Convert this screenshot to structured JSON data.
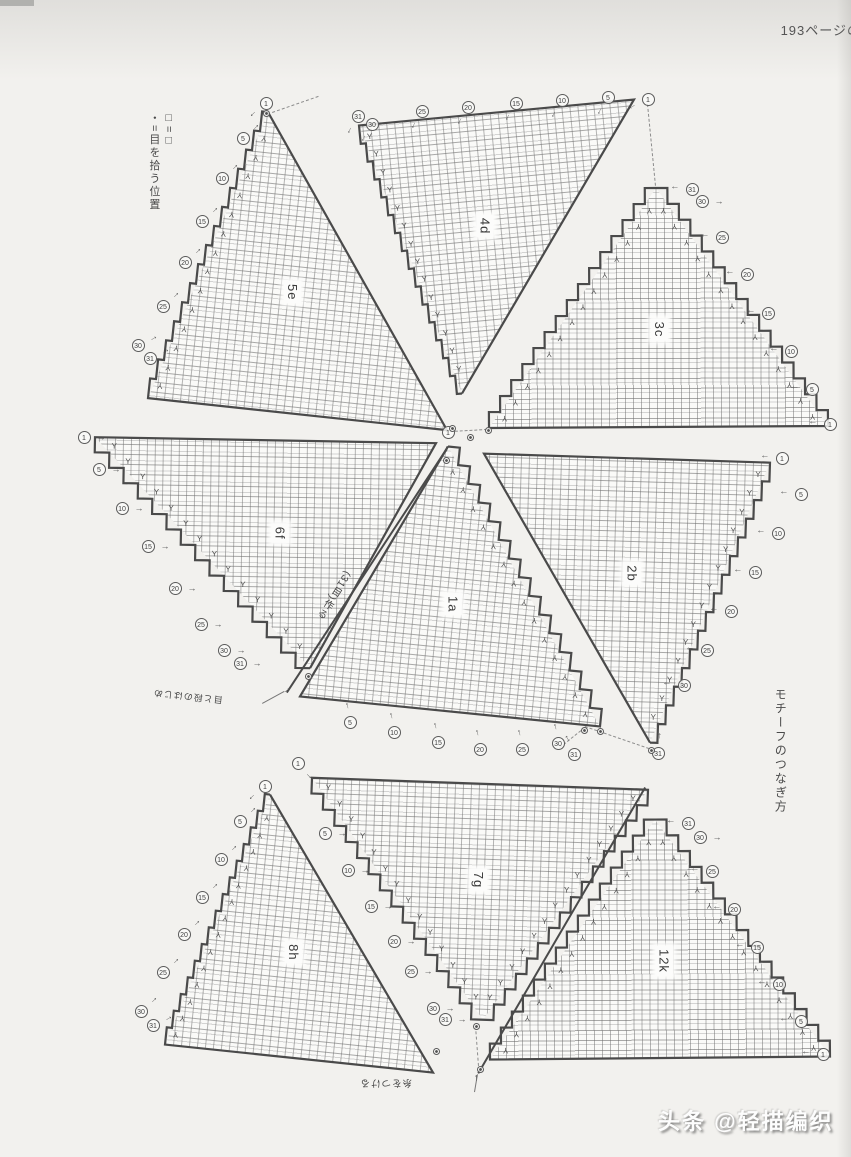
{
  "page": {
    "header_note": "193ページの続き",
    "side_note": "モチーフのつなぎ方",
    "watermark": "头条 @轻描编织",
    "legend_line1": "□=□",
    "legend_line2": "・=目を拾う位置",
    "accent_outline_color": "#4a4a4a",
    "paper_color": "#f2f1ee"
  },
  "annotations": [
    {
      "id": "cast-on-note",
      "text": "(31目)作る",
      "x": 342,
      "y": 568,
      "rotate": 33,
      "vertical": true,
      "size": 10
    },
    {
      "id": "start-note",
      "text": "目と段のはじめ",
      "x": 222,
      "y": 706,
      "rotate": 186,
      "vertical": false,
      "size": 9
    },
    {
      "id": "attach-yarn-note",
      "text": "糸をつける",
      "x": 412,
      "y": 1088,
      "rotate": 180,
      "vertical": false,
      "size": 9.5
    }
  ],
  "triangles": [
    {
      "id": "5e",
      "label": "5e",
      "apex": [
        268,
        112
      ],
      "bl": [
        148,
        398
      ],
      "br": [
        447,
        430
      ],
      "left": "step",
      "right": "line"
    },
    {
      "id": "4d",
      "label": "4d",
      "apex": [
        462,
        393
      ],
      "bl": [
        634,
        99
      ],
      "br": [
        359,
        125
      ],
      "left": "line",
      "right": "step"
    },
    {
      "id": "3c",
      "label": "3c",
      "apex": [
        656,
        188
      ],
      "bl": [
        489,
        428
      ],
      "br": [
        828,
        426
      ],
      "left": "step",
      "right": "step"
    },
    {
      "id": "6f",
      "label": "6f",
      "apex": [
        310,
        668
      ],
      "bl": [
        436,
        443
      ],
      "br": [
        95,
        437
      ],
      "left": "line",
      "right": "step"
    },
    {
      "id": "2b",
      "label": "2b",
      "apex": [
        650,
        743
      ],
      "bl": [
        770,
        463
      ],
      "br": [
        484,
        454
      ],
      "left": "step",
      "right": "line"
    },
    {
      "id": "1a",
      "label": "1a",
      "apex": [
        448,
        446
      ],
      "bl": [
        300,
        696
      ],
      "br": [
        600,
        726
      ],
      "left": "line",
      "right": "step"
    },
    {
      "id": "7g",
      "label": "7g",
      "apex": [
        483,
        1020
      ],
      "bl": [
        648,
        790
      ],
      "br": [
        312,
        778
      ],
      "left": "step",
      "right": "step"
    },
    {
      "id": "8h",
      "label": "8h",
      "apex": [
        270,
        795
      ],
      "bl": [
        165,
        1045
      ],
      "br": [
        433,
        1073
      ],
      "left": "step",
      "right": "line"
    },
    {
      "id": "12k",
      "label": "12k",
      "apex": [
        655,
        820
      ],
      "bl": [
        490,
        1060
      ],
      "br": [
        830,
        1057
      ],
      "left": "step",
      "right": "step"
    }
  ],
  "markers": [
    {
      "x": 266,
      "y": 103,
      "n": "1",
      "ad": 135
    },
    {
      "x": 243,
      "y": 138,
      "n": "5",
      "ad": -45
    },
    {
      "x": 222,
      "y": 178,
      "n": "10",
      "ad": -45
    },
    {
      "x": 202,
      "y": 221,
      "n": "15",
      "ad": -45
    },
    {
      "x": 185,
      "y": 262,
      "n": "20",
      "ad": -45
    },
    {
      "x": 163,
      "y": 306,
      "n": "25",
      "ad": -45
    },
    {
      "x": 138,
      "y": 345,
      "n": "30",
      "ad": -30
    },
    {
      "x": 150,
      "y": 358,
      "n": "31",
      "ad": -30
    },
    {
      "x": 358,
      "y": 116,
      "n": "31",
      "ad": 115
    },
    {
      "x": 372,
      "y": 124,
      "n": "30",
      "ad": 115
    },
    {
      "x": 422,
      "y": 111,
      "n": "25",
      "ad": 115
    },
    {
      "x": 468,
      "y": 107,
      "n": "20",
      "ad": 115
    },
    {
      "x": 516,
      "y": 103,
      "n": "15",
      "ad": 115
    },
    {
      "x": 562,
      "y": 100,
      "n": "10",
      "ad": 115
    },
    {
      "x": 608,
      "y": 97,
      "n": "5",
      "ad": 115
    },
    {
      "x": 648,
      "y": 99,
      "n": "1",
      "ad": 150
    },
    {
      "x": 692,
      "y": 189,
      "n": "31",
      "ad": 180
    },
    {
      "x": 702,
      "y": 201,
      "n": "30",
      "ad": 0
    },
    {
      "x": 722,
      "y": 237,
      "n": "25",
      "ad": 180
    },
    {
      "x": 747,
      "y": 274,
      "n": "20",
      "ad": 180
    },
    {
      "x": 768,
      "y": 313,
      "n": "15",
      "ad": 180
    },
    {
      "x": 791,
      "y": 351,
      "n": "10",
      "ad": 180
    },
    {
      "x": 812,
      "y": 389,
      "n": "5",
      "ad": 180
    },
    {
      "x": 830,
      "y": 424,
      "n": "1",
      "ad": 180
    },
    {
      "x": 84,
      "y": 437,
      "n": "1",
      "ad": 0
    },
    {
      "x": 99,
      "y": 469,
      "n": "5",
      "ad": 0
    },
    {
      "x": 122,
      "y": 508,
      "n": "10",
      "ad": 0
    },
    {
      "x": 148,
      "y": 546,
      "n": "15",
      "ad": 0
    },
    {
      "x": 175,
      "y": 588,
      "n": "20",
      "ad": 0
    },
    {
      "x": 201,
      "y": 624,
      "n": "25",
      "ad": 0
    },
    {
      "x": 224,
      "y": 650,
      "n": "30",
      "ad": 0
    },
    {
      "x": 240,
      "y": 663,
      "n": "31",
      "ad": 0
    },
    {
      "x": 782,
      "y": 458,
      "n": "1",
      "ad": 180
    },
    {
      "x": 801,
      "y": 494,
      "n": "5",
      "ad": 180
    },
    {
      "x": 778,
      "y": 533,
      "n": "10",
      "ad": 180
    },
    {
      "x": 755,
      "y": 572,
      "n": "15",
      "ad": 180
    },
    {
      "x": 731,
      "y": 611,
      "n": "20",
      "ad": 180
    },
    {
      "x": 707,
      "y": 650,
      "n": "25",
      "ad": 180
    },
    {
      "x": 684,
      "y": 685,
      "n": "30",
      "ad": 180
    },
    {
      "x": 658,
      "y": 753,
      "n": "31",
      "ad": -90
    },
    {
      "x": 448,
      "y": 432,
      "n": "1",
      "ad": 90
    },
    {
      "x": 350,
      "y": 722,
      "n": "5",
      "ad": -105
    },
    {
      "x": 394,
      "y": 732,
      "n": "10",
      "ad": -105
    },
    {
      "x": 438,
      "y": 742,
      "n": "15",
      "ad": -105
    },
    {
      "x": 480,
      "y": 749,
      "n": "20",
      "ad": -105
    },
    {
      "x": 522,
      "y": 749,
      "n": "25",
      "ad": -105
    },
    {
      "x": 558,
      "y": 743,
      "n": "30",
      "ad": -105
    },
    {
      "x": 574,
      "y": 754,
      "n": "31",
      "ad": -120
    },
    {
      "x": 298,
      "y": 763,
      "n": "1",
      "ad": 45
    },
    {
      "x": 325,
      "y": 833,
      "n": "5",
      "ad": 0
    },
    {
      "x": 348,
      "y": 870,
      "n": "10",
      "ad": 0
    },
    {
      "x": 371,
      "y": 906,
      "n": "15",
      "ad": 0
    },
    {
      "x": 394,
      "y": 941,
      "n": "20",
      "ad": 0
    },
    {
      "x": 411,
      "y": 971,
      "n": "25",
      "ad": 0
    },
    {
      "x": 433,
      "y": 1008,
      "n": "30",
      "ad": 0
    },
    {
      "x": 445,
      "y": 1019,
      "n": "31",
      "ad": 0
    },
    {
      "x": 265,
      "y": 786,
      "n": "1",
      "ad": 135
    },
    {
      "x": 240,
      "y": 821,
      "n": "5",
      "ad": -45
    },
    {
      "x": 221,
      "y": 859,
      "n": "10",
      "ad": -45
    },
    {
      "x": 202,
      "y": 897,
      "n": "15",
      "ad": -45
    },
    {
      "x": 184,
      "y": 934,
      "n": "20",
      "ad": -45
    },
    {
      "x": 163,
      "y": 972,
      "n": "25",
      "ad": -45
    },
    {
      "x": 141,
      "y": 1011,
      "n": "30",
      "ad": -45
    },
    {
      "x": 153,
      "y": 1025,
      "n": "31",
      "ad": -30
    },
    {
      "x": 688,
      "y": 823,
      "n": "31",
      "ad": 180
    },
    {
      "x": 700,
      "y": 837,
      "n": "30",
      "ad": 0
    },
    {
      "x": 712,
      "y": 871,
      "n": "25",
      "ad": 180
    },
    {
      "x": 734,
      "y": 909,
      "n": "20",
      "ad": 180
    },
    {
      "x": 757,
      "y": 947,
      "n": "15",
      "ad": 180
    },
    {
      "x": 779,
      "y": 984,
      "n": "10",
      "ad": 180
    },
    {
      "x": 801,
      "y": 1021,
      "n": "5",
      "ad": 180
    },
    {
      "x": 823,
      "y": 1054,
      "n": "1",
      "ad": 180
    }
  ],
  "pickup_dots": [
    {
      "x": 452,
      "y": 428
    },
    {
      "x": 470,
      "y": 437
    },
    {
      "x": 488,
      "y": 430
    },
    {
      "x": 446,
      "y": 460
    },
    {
      "x": 308,
      "y": 676
    },
    {
      "x": 584,
      "y": 730
    },
    {
      "x": 600,
      "y": 731
    },
    {
      "x": 651,
      "y": 750
    },
    {
      "x": 476,
      "y": 1026
    },
    {
      "x": 480,
      "y": 1069
    },
    {
      "x": 436,
      "y": 1051
    },
    {
      "x": 266,
      "y": 113
    }
  ],
  "lines": {
    "bold": [
      [
        286,
        692,
        446,
        448
      ],
      [
        646,
        788,
        479,
        1074
      ]
    ],
    "dashed": [
      [
        648,
        104,
        656,
        186
      ],
      [
        585,
        726,
        649,
        748
      ],
      [
        585,
        728,
        560,
        748
      ],
      [
        476,
        1026,
        479,
        1066
      ],
      [
        450,
        431,
        487,
        429
      ],
      [
        272,
        112,
        318,
        96
      ]
    ],
    "thin": [
      [
        474,
        1092,
        477,
        1074
      ],
      [
        262,
        703,
        284,
        691
      ]
    ]
  },
  "arrows": [
    {
      "x": 287,
      "y": 690,
      "r": -35
    },
    {
      "x": 476,
      "y": 1078,
      "r": -93
    }
  ]
}
